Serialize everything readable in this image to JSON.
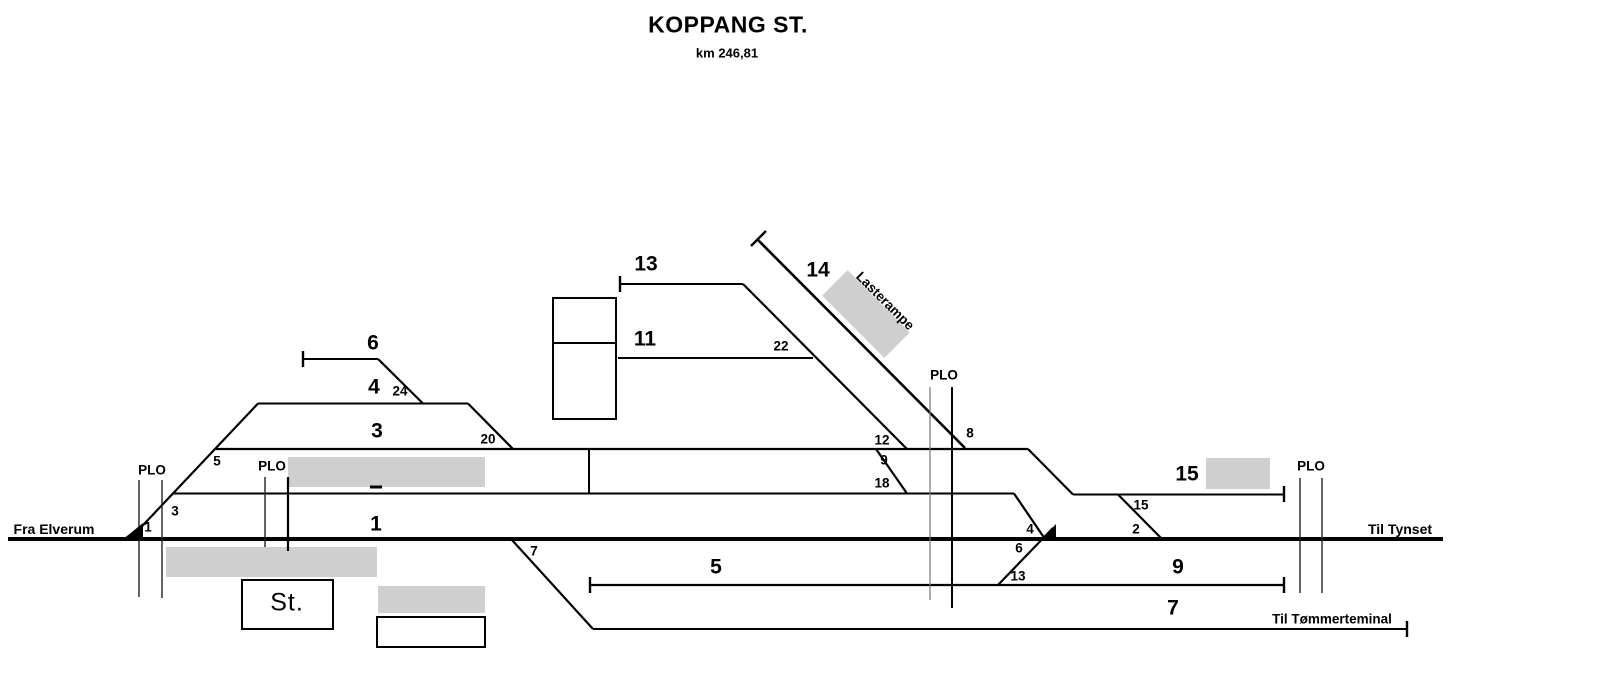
{
  "title": "KOPPANG ST.",
  "subtitle": "km 246,81",
  "endpoints": {
    "west": "Fra Elverum",
    "east": "Til Tynset",
    "branch": "Til Tømmerteminal"
  },
  "station_box_label": "St.",
  "ramp_label": "Lasterampe",
  "level_crossing_label": "PLO",
  "tracks": {
    "t1": "1",
    "t3": "3",
    "t4": "4",
    "t5": "5",
    "t6": "6",
    "t7": "7",
    "t9": "9",
    "t11": "11",
    "t13": "13",
    "t14": "14",
    "t15": "15"
  },
  "switches": {
    "s1": "1",
    "s2": "2",
    "s3": "3",
    "s4": "4",
    "s5": "5",
    "s6": "6",
    "s7": "7",
    "s8": "8",
    "s9": "9",
    "s12": "12",
    "s13": "13",
    "s15": "15",
    "s18": "18",
    "s20": "20",
    "s22": "22",
    "s24": "24"
  },
  "colors": {
    "line": "#000000",
    "platform_gray": "#cfcfcf",
    "background": "#ffffff"
  }
}
